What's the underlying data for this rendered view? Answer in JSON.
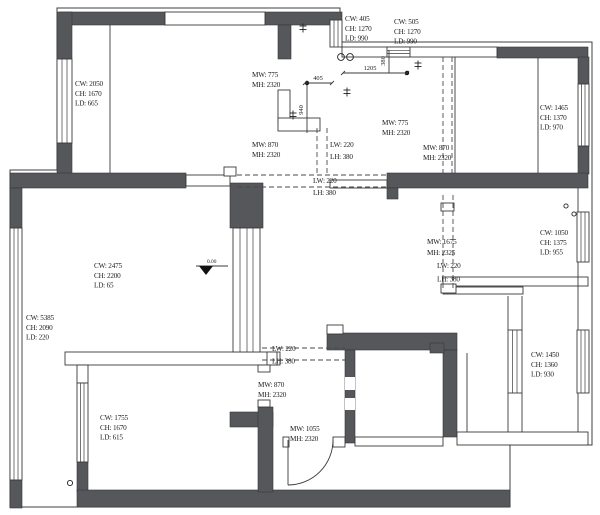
{
  "drawing": {
    "type": "apartment-floor-plan",
    "units": "mm",
    "colors": {
      "wall_fill": "#55575a",
      "line": "#3a3a3a",
      "background": "#ffffff"
    }
  },
  "labels": {
    "win_tl": {
      "l1": "CW: 2050",
      "l2": "CH: 1670",
      "l3": "LD: 665"
    },
    "win_k1": {
      "l1": "CW: 405",
      "l2": "CH: 1270",
      "l3": "LD: 990"
    },
    "win_k2": {
      "l1": "CW: 505",
      "l2": "CH: 1270",
      "l3": "LD: 990"
    },
    "win_tr": {
      "l1": "CW: 1465",
      "l2": "CH: 1370",
      "l3": "LD: 970"
    },
    "win_bal": {
      "l1": "CW: 2475",
      "l2": "CH: 2200",
      "l3": "LD: 65"
    },
    "win_left": {
      "l1": "CW: 5385",
      "l2": "CH: 2090",
      "l3": "LD: 220"
    },
    "win_bl": {
      "l1": "CW: 1755",
      "l2": "CH: 1670",
      "l3": "LD: 615"
    },
    "win_r1": {
      "l1": "CW: 1050",
      "l2": "CH: 1375",
      "l3": "LD: 955"
    },
    "win_br": {
      "l1": "CW: 1450",
      "l2": "CH: 1360",
      "l3": "LD: 930"
    },
    "door_k1": {
      "l1": "MW: 775",
      "l2": "MH: 2320"
    },
    "door_m1": {
      "l1": "MW: 870",
      "l2": "MH: 2320"
    },
    "door_k2": {
      "l1": "MW: 775",
      "l2": "MH: 2320"
    },
    "door_m2": {
      "l1": "MW: 870",
      "l2": "MH: 2320"
    },
    "door_bl": {
      "l1": "MW: 870",
      "l2": "MH: 2320"
    },
    "door_entry": {
      "l1": "MW: 1055",
      "l2": "MH: 2320"
    },
    "door_r": {
      "l1": "MW: 1675",
      "l2": "MH: 2325"
    },
    "beam_v1": {
      "l1": "LW: 220",
      "l2": "LH: 380"
    },
    "beam_h1": {
      "l1": "LW: 220",
      "l2": "LH: 380"
    },
    "beam_h2": {
      "l1": "LW: 220",
      "l2": "LH: 380"
    },
    "beam_r": {
      "l1": "LW: 220",
      "l2": "LH: 380"
    }
  },
  "dims": {
    "d405": "405",
    "d940": "940",
    "d1205": "1205",
    "d380": "380",
    "level": "0.00"
  }
}
